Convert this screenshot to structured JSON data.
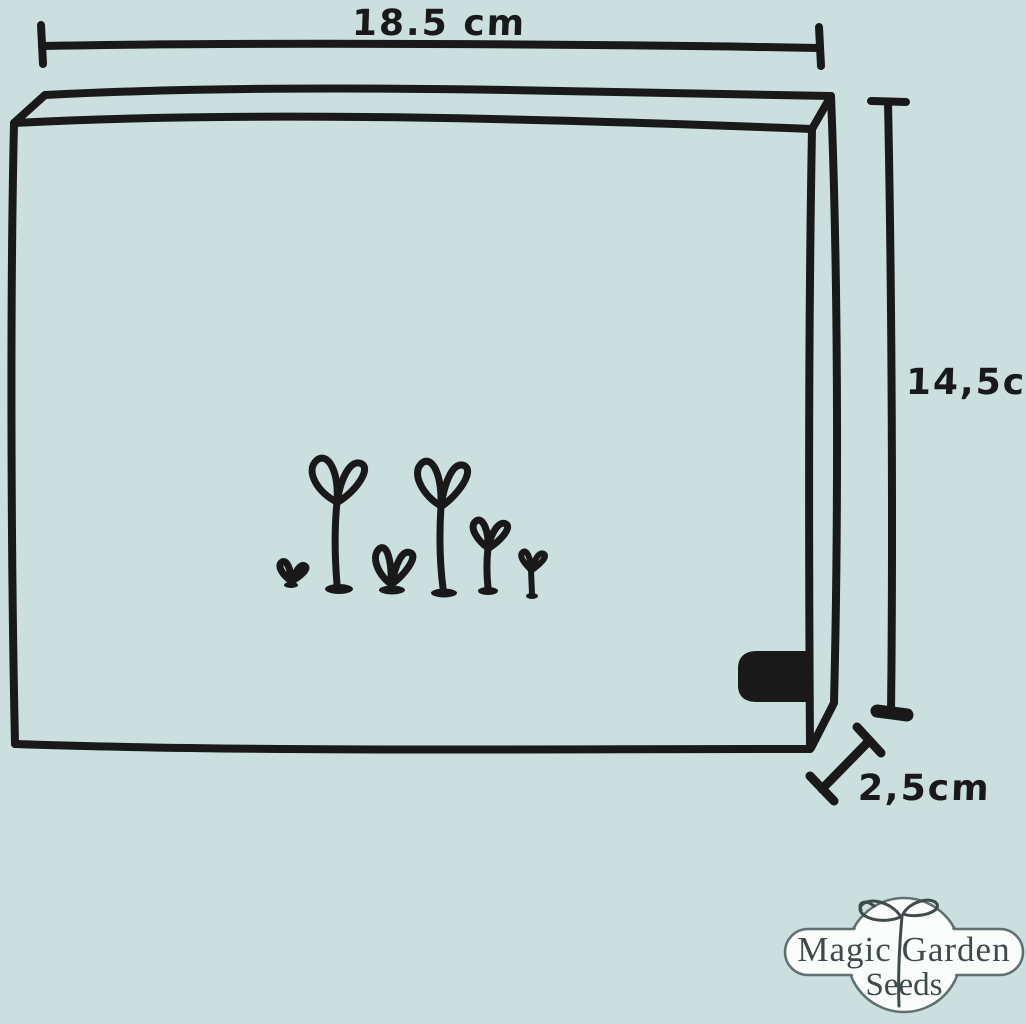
{
  "canvas": {
    "background_color": "#cbdfdf",
    "ink_color": "#191919",
    "description": "Hand-drawn diagram of a seed box with six sprouting seedlings and its outer dimensions"
  },
  "diagram": {
    "width_label": "18.5 cm",
    "height_label": "14,5cm",
    "depth_label": "2,5cm",
    "sprout_count": 6,
    "box_feature": "black label mark on lower right edge"
  },
  "logo": {
    "title": "Magic Garden",
    "subtitle": "Seeds",
    "text_color": "#3d4b4b",
    "badge_fill": "#fbfdfd",
    "badge_outline": "#5f7070",
    "emblem": "seedling-icon"
  }
}
